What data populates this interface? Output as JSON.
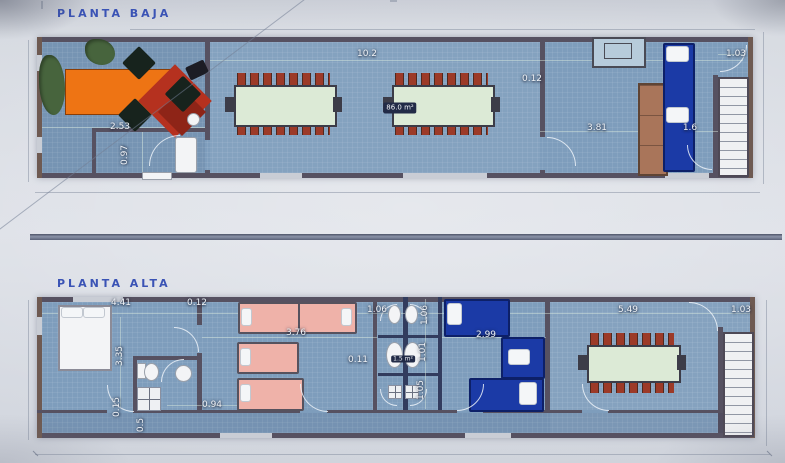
{
  "document": {
    "type": "architectural floor plan photo",
    "language": "Spanish"
  },
  "colors": {
    "title_blue": "#3a53b5",
    "floor_blue": "#7e9dbc",
    "wall_dark": "#565161",
    "table_green": "#dcead6",
    "chair_red": "#9c3a28",
    "desk_orange": "#ee7414",
    "desk_red": "#b5311f",
    "plant_green": "#47643d",
    "bed_navy": "#1b3aa6",
    "bed_pink": "#efb2a9"
  },
  "planta_baja": {
    "title": "PLANTA BAJA",
    "area_label": "86.0 m²",
    "dims": [
      {
        "name": "overall-length",
        "value": "10.2"
      },
      {
        "name": "office-width",
        "value": "2.53"
      },
      {
        "name": "corridor-width",
        "value": "0.97"
      },
      {
        "name": "partition-thickness",
        "value": "0.12"
      },
      {
        "name": "right-room-length",
        "value": "3.81"
      },
      {
        "name": "bed-alcove-width",
        "value": "1.6"
      },
      {
        "name": "stair-width",
        "value": "1.03"
      }
    ]
  },
  "planta_alta": {
    "title": "PLANTA ALTA",
    "bath_area_label": "1.5 m²",
    "dims": [
      {
        "name": "bedroom-width",
        "value": "4.41"
      },
      {
        "name": "wall-thickness",
        "value": "0.12"
      },
      {
        "name": "bedroom-depth",
        "value": "3.35"
      },
      {
        "name": "hall-width",
        "value": "0.15"
      },
      {
        "name": "shower-width",
        "value": "0.5"
      },
      {
        "name": "corridor-door-width",
        "value": "0.94"
      },
      {
        "name": "beds-room-length",
        "value": "3.76"
      },
      {
        "name": "bathroom-width",
        "value": "1.06"
      },
      {
        "name": "bathroom-depth",
        "value": "1.06"
      },
      {
        "name": "wall-gap",
        "value": "0.11"
      },
      {
        "name": "bathroom-mid-depth",
        "value": "1.01"
      },
      {
        "name": "bathroom-lower-depth",
        "value": "1.05"
      },
      {
        "name": "blue-room-length",
        "value": "2.99"
      },
      {
        "name": "dining-room-length",
        "value": "5.49"
      },
      {
        "name": "stair-width",
        "value": "1.03"
      }
    ]
  }
}
